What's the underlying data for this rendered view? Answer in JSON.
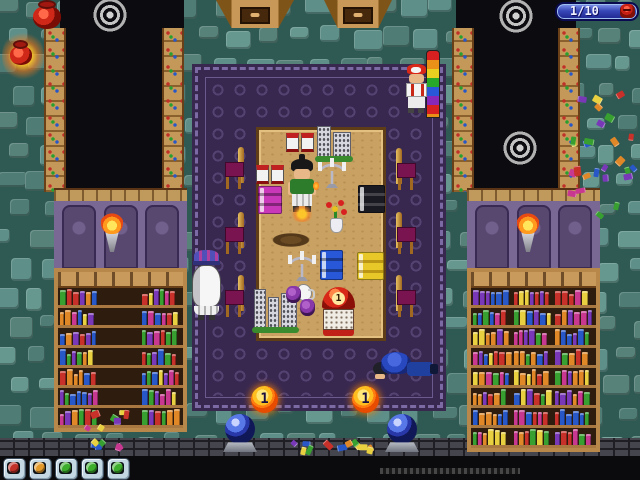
{
  "hud": {
    "counter_label": "1/10",
    "icon": "red-enemy-icon",
    "colors": {
      "fill_top": "#8298ec",
      "fill_bottom": "#1e2690",
      "border": "#0a0a50",
      "icon_red": "#c81f14"
    }
  },
  "toolbar": {
    "buttons": [
      {
        "name": "toolbar-button-red",
        "color": "#c23128"
      },
      {
        "name": "toolbar-button-orange",
        "color": "#e39a2b"
      },
      {
        "name": "toolbar-button-green-1",
        "color": "#3cae2c"
      },
      {
        "name": "toolbar-button-green-2",
        "color": "#3cae2c"
      },
      {
        "name": "toolbar-button-green-3",
        "color": "#3cae2c"
      }
    ]
  },
  "game": {
    "coins": [
      {
        "value": "1"
      },
      {
        "value": "1"
      }
    ],
    "register_value": "1",
    "entities": [
      "player-character",
      "chef-npc",
      "red-cap-npc",
      "sleeping-npc"
    ],
    "props": [
      "wooden-table",
      "chairs",
      "bookshelves",
      "torches",
      "candelabras",
      "books",
      "flower-vase",
      "crystal-orbs",
      "coins",
      "red-register",
      "rainbow-pole",
      "red-pots",
      "circle-emblems"
    ]
  },
  "palette": {
    "floor_grout": "#2f5a54",
    "stone": "#5e8f88",
    "carpet": "#382850",
    "carpet_border": "#7c6aa4",
    "table_wood": "#c9a263",
    "wall_purple": "#7a6894",
    "alcove_black": "#0c0c10",
    "shelf_wood": "#b8874a",
    "book_colors": [
      "#c8302a",
      "#e08828",
      "#e8d040",
      "#38a030",
      "#2858c8",
      "#7838b8",
      "#c83890"
    ]
  }
}
